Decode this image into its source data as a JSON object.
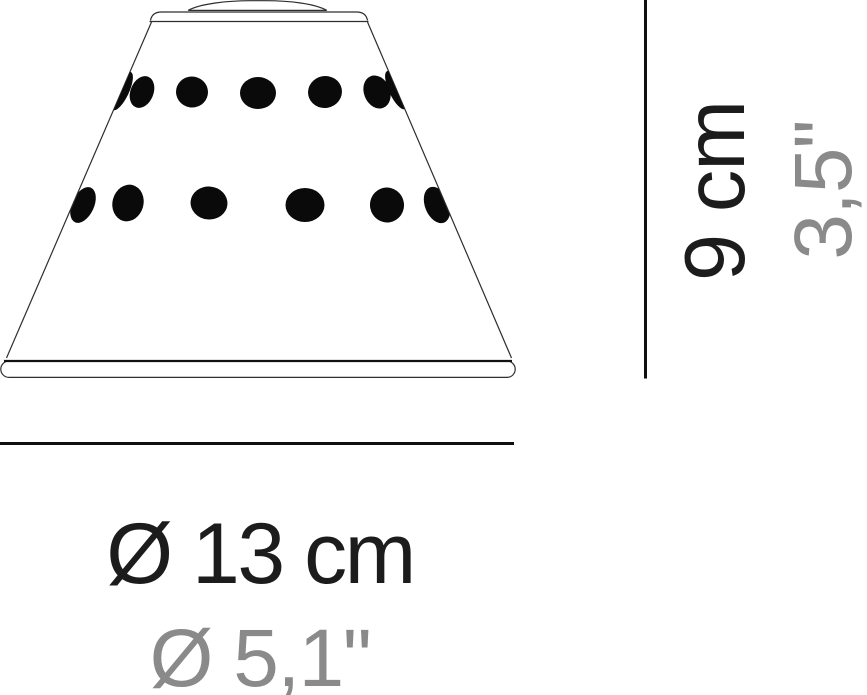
{
  "diagram": {
    "subject": "perforated cone lampshade dimension drawing",
    "height": {
      "metric": "9 cm",
      "imperial": "3,5\""
    },
    "diameter": {
      "metric": "Ø 13 cm",
      "imperial": "Ø 5,1\""
    },
    "colors": {
      "line": "#1f1f1f",
      "perforation_fill": "#0a0a0a",
      "metric_text": "#1c1c1c",
      "imperial_text": "#8a8a8a",
      "background": "#ffffff"
    }
  }
}
